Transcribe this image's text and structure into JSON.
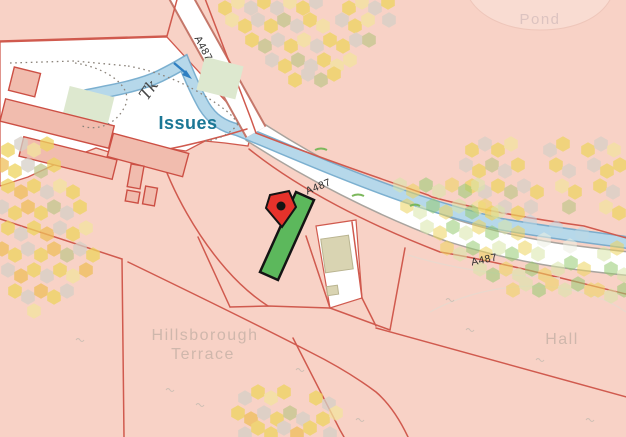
{
  "map": {
    "labels": {
      "pond": "Pond",
      "track": "Tk",
      "issues": "Issues",
      "road_name": "A487",
      "terrace_line1": "Hillsborough",
      "terrace_line2": "Terrace",
      "hall": "Hall"
    },
    "highlight": {
      "parcel_color": "#5cb85c",
      "marker_color": "#e6322b"
    },
    "colors": {
      "parcel_pink": "#f8d2c6",
      "building_pink": "#f1bcae",
      "boundary_red": "#d05a4e",
      "water_blue": "#b6d8ea",
      "water_edge_blue": "#6ea7cb",
      "road_white": "#ffffff",
      "label_teal": "#1b7795",
      "faint_label": "#cfb7ac"
    }
  }
}
